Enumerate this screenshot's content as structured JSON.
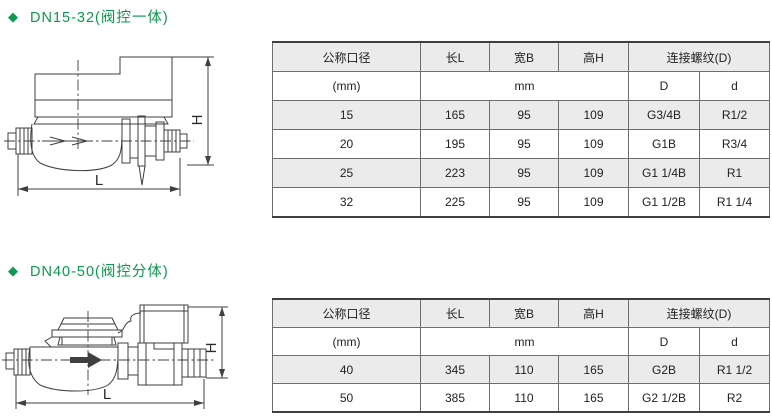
{
  "colors": {
    "accent_green": "#089b4c",
    "row_fill_gray": "#ebebeb",
    "border_gray": "#6e6e6e"
  },
  "sections": [
    {
      "bullet": "◆",
      "heading": "DN15-32(阀控一体)",
      "drawing": {
        "height_label": "H",
        "length_label": "L"
      },
      "table": {
        "header_row1": [
          "公称口径",
          "长L",
          "宽B",
          "高H",
          "连接螺纹(D)"
        ],
        "header_row2": {
          "col1": "(mm)",
          "unit": "mm",
          "D": "D",
          "d": "d"
        },
        "rows": [
          [
            "15",
            "165",
            "95",
            "109",
            "G3/4B",
            "R1/2"
          ],
          [
            "20",
            "195",
            "95",
            "109",
            "G1B",
            "R3/4"
          ],
          [
            "25",
            "223",
            "95",
            "109",
            "G1 1/4B",
            "R1"
          ],
          [
            "32",
            "225",
            "95",
            "109",
            "G1 1/2B",
            "R1 1/4"
          ]
        ]
      }
    },
    {
      "bullet": "◆",
      "heading": "DN40-50(阀控分体)",
      "drawing": {
        "height_label": "H",
        "length_label": "L"
      },
      "table": {
        "header_row1": [
          "公称口径",
          "长L",
          "宽B",
          "高H",
          "连接螺纹(D)"
        ],
        "header_row2": {
          "col1": "(mm)",
          "unit": "mm",
          "D": "D",
          "d": "d"
        },
        "rows": [
          [
            "40",
            "345",
            "110",
            "165",
            "G2B",
            "R1 1/2"
          ],
          [
            "50",
            "385",
            "110",
            "165",
            "G2 1/2B",
            "R2"
          ]
        ]
      }
    }
  ]
}
